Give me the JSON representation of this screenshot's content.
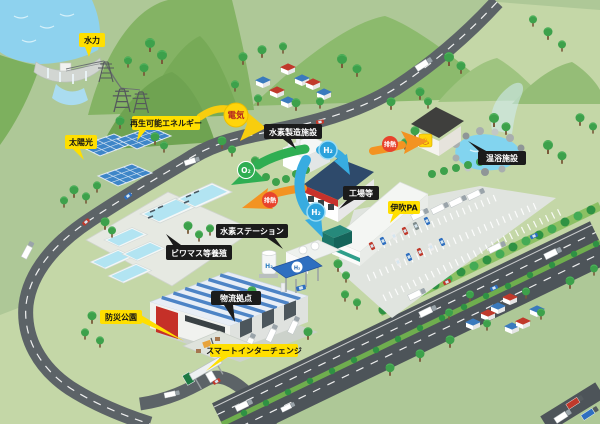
{
  "labels": {
    "hydro": "水力",
    "renewable": "再生可能エネルギー",
    "solar": "太陽光",
    "h2_plant": "水素製造施設",
    "factory": "工場等",
    "onsen": "温浴施設",
    "ibuki_pa": "伊吹PA",
    "h2_station": "水素ステーション",
    "aquafarm": "ビワマス等養殖",
    "logistics": "物流拠点",
    "disaster_park": "防災公園",
    "smart_ic": "スマートインターチェンジ"
  },
  "badges": {
    "electricity": "電気",
    "o2": "O₂",
    "h2": "H₂",
    "heat": "排熱"
  },
  "icons": {
    "onsen_symbol": "♨"
  },
  "colors": {
    "label_yellow": "#ffdf00",
    "label_black": "#1b1b1b",
    "arrow_electricity": "#f8cd0e",
    "arrow_o2": "#2fae52",
    "arrow_heat": "#f39322",
    "arrow_h2": "#38ace0",
    "badge_electricity_text": "#b5271f",
    "badge_heat": "#e8432c",
    "badge_h2": "#2aa2dc",
    "water": "#8ed2ee",
    "land": "#aec897",
    "land_light": "#c4d7a7",
    "road": "#5c6367",
    "highway": "#4d5459"
  }
}
